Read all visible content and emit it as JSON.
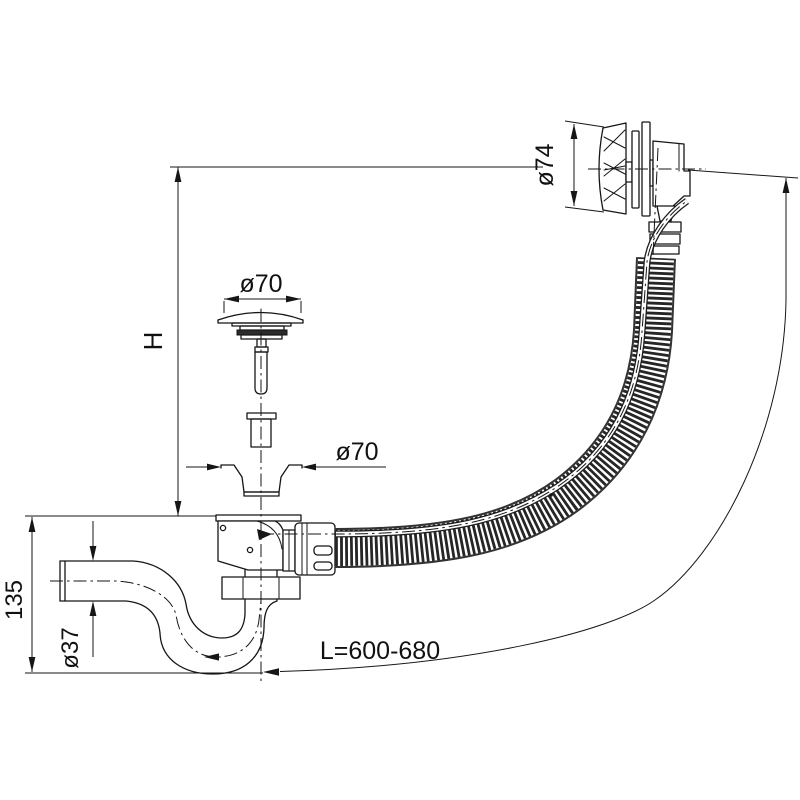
{
  "labels": {
    "plug_diameter": "ø70",
    "flange_diameter": "ø70",
    "overflow_diameter": "ø74",
    "installation_height": "H",
    "trap_height": "135",
    "pipe_diameter": "ø37",
    "hose_length": "L=600-680"
  },
  "colors": {
    "line": "#161616",
    "background": "#ffffff",
    "hose": "#262626"
  }
}
